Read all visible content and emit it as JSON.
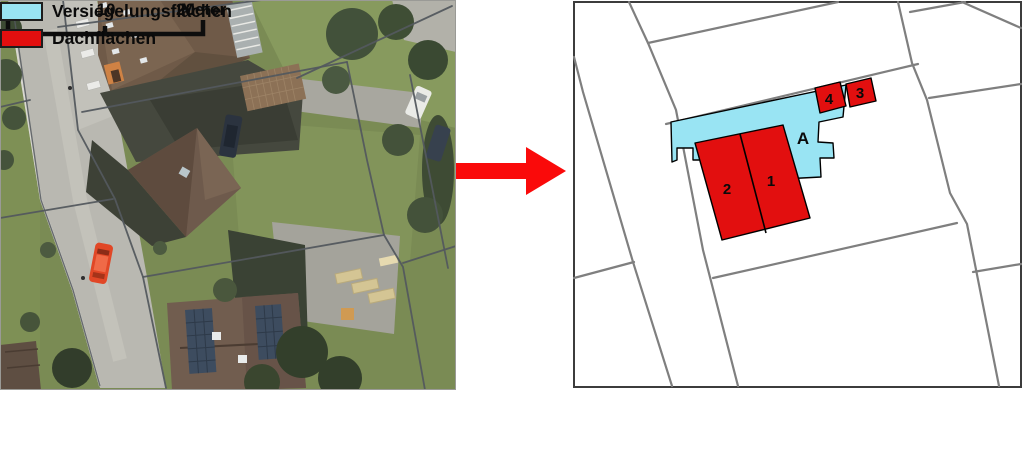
{
  "map": {
    "labels": {
      "sealed": "A",
      "roof1": "1",
      "roof2": "2",
      "roof3": "3",
      "roof4": "4"
    }
  },
  "scalebar": {
    "ticks": [
      "0",
      "10",
      "20"
    ],
    "unit": "Meter"
  },
  "legend": {
    "items": [
      {
        "id": "sealed",
        "label": "Versiegelungsflächen"
      },
      {
        "id": "roof",
        "label": "Dachflächen"
      }
    ]
  },
  "colors": {
    "sealed": "#99e4f3",
    "roof": "#e20f0f",
    "arrow": "#fa0a0a",
    "parcel": "#7f7f7f",
    "frame": "#3c3c3c",
    "overlay": "#53585e",
    "text": "#0a0a0a"
  }
}
